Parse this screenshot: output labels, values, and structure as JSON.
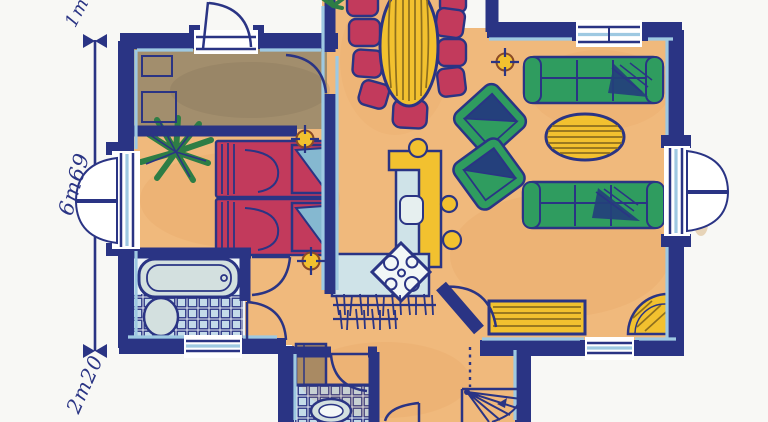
{
  "drawing": {
    "kind": "hand-drawn watercolor floor plan"
  },
  "dimensions": {
    "top_label": "1m",
    "middle_label": "6m69",
    "bottom_label": "2m20"
  },
  "palette": {
    "paper": "#f8f8f5",
    "navy": "#2a3484",
    "light_blue": "#9ec9e2",
    "floor_orange": "#f0b97c",
    "floor_brown": "#a28e6d",
    "tile_blue": "#c4dbe9",
    "fixture_grey": "#d3e0df",
    "sofa_green": "#2f9c5f",
    "green_dark": "#1f7547",
    "chair_red": "#c23a5c",
    "pillow_blue": "#85b8d0",
    "accent_yellow": "#f2c12f",
    "stripe_dark": "#8e6f1e",
    "shadow_navy": "#24407c",
    "cabinet_brown": "#a98a63"
  },
  "symbols": {
    "rooms": [
      "entry",
      "bedroom",
      "bathroom",
      "kitchen",
      "dining-area",
      "living-room",
      "hall",
      "wc",
      "stair-well"
    ],
    "furniture_and_icons": [
      "twin-bed",
      "bathtub",
      "toilet",
      "dining-table",
      "dining-chair",
      "kitchen-counter",
      "bar-counter",
      "stove",
      "sink",
      "bar-stool",
      "sofa",
      "armchair",
      "coffee-table",
      "sideboard",
      "corner-unit",
      "plant",
      "ceiling-light",
      "radiator-hatch",
      "spiral-stair",
      "wardrobe",
      "window-shutters",
      "french-doors"
    ]
  }
}
